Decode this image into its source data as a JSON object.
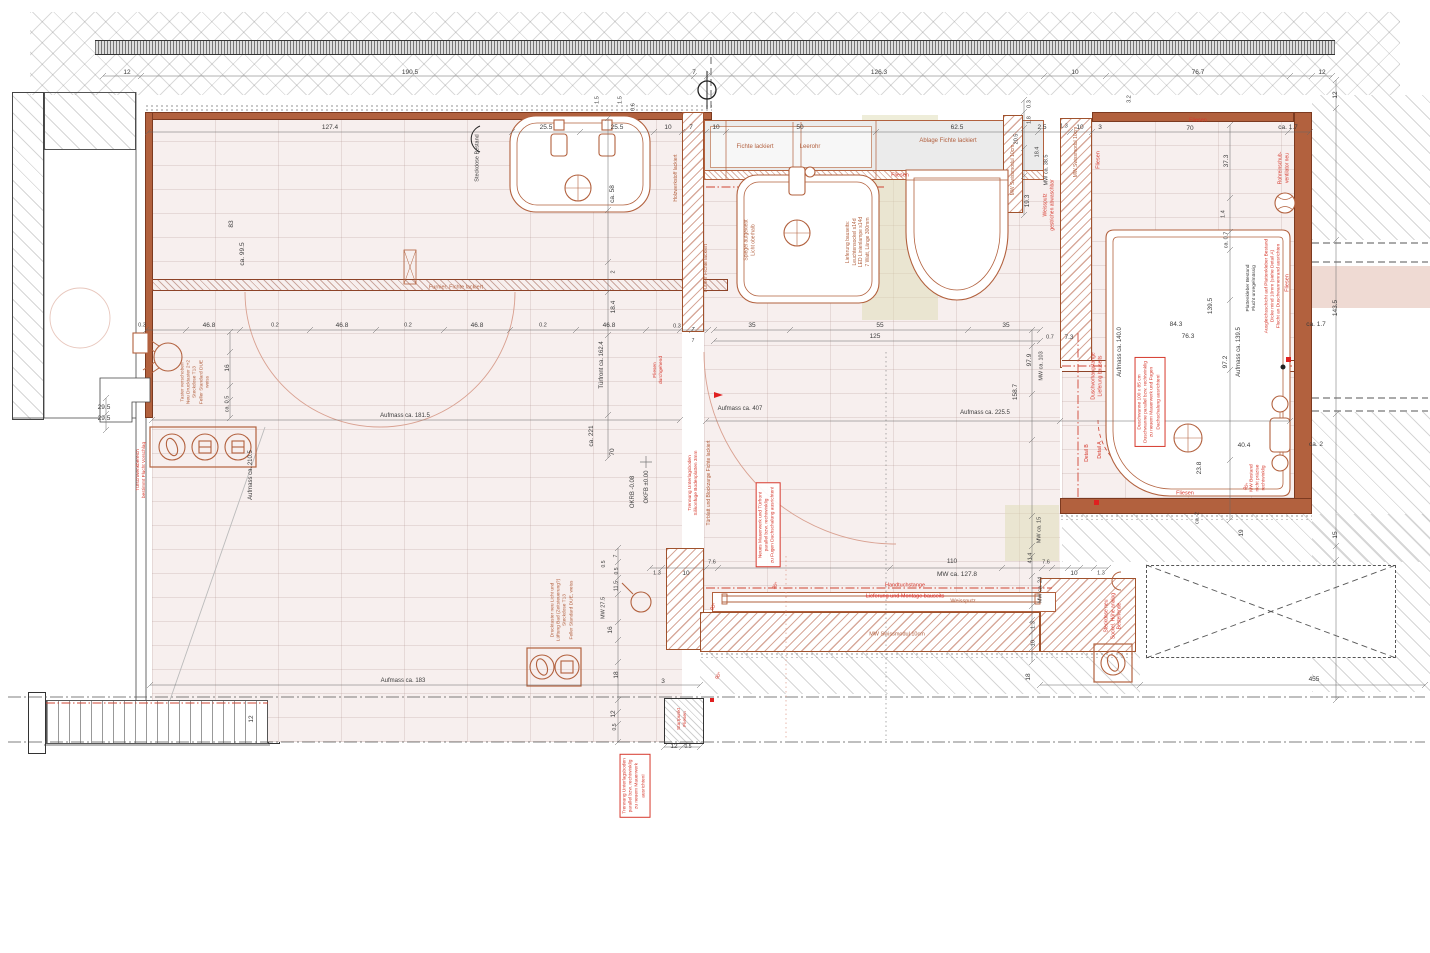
{
  "drawing": {
    "kind": "bathroom renovation floor plan",
    "language": "de"
  },
  "colors": {
    "dim_text": "#3c3c3c",
    "red_note": "#d6382c",
    "wood_note": "#b2603f",
    "wall": "#b2613e"
  },
  "annotations": [
    {
      "t": "12",
      "x": 127,
      "y": 73
    },
    {
      "t": "190.5",
      "x": 410,
      "y": 73
    },
    {
      "t": "7",
      "x": 694,
      "y": 73
    },
    {
      "t": "126.3",
      "x": 879,
      "y": 73
    },
    {
      "t": "10",
      "x": 1075,
      "y": 73
    },
    {
      "t": "76.7",
      "x": 1198,
      "y": 73
    },
    {
      "t": "12",
      "x": 1322,
      "y": 73
    },
    {
      "t": "12",
      "x": 1336,
      "y": 95,
      "r": -90
    },
    {
      "t": "127.4",
      "x": 330,
      "y": 128
    },
    {
      "t": "25.5",
      "x": 546,
      "y": 128
    },
    {
      "t": "25.5",
      "x": 617,
      "y": 128
    },
    {
      "t": "10",
      "x": 668,
      "y": 128
    },
    {
      "t": "7",
      "x": 691,
      "y": 128
    },
    {
      "t": "10",
      "x": 716,
      "y": 128
    },
    {
      "t": "1.5",
      "x": 598,
      "y": 100,
      "r": -90,
      "s": 5.5
    },
    {
      "t": "1.5",
      "x": 621,
      "y": 100,
      "r": -90,
      "s": 5.5
    },
    {
      "t": "0.6",
      "x": 634,
      "y": 107,
      "r": -90,
      "s": 5.5
    },
    {
      "t": "50",
      "x": 800,
      "y": 128
    },
    {
      "t": "62.5",
      "x": 957,
      "y": 128
    },
    {
      "t": "2.5",
      "x": 1042,
      "y": 128
    },
    {
      "t": "1.3",
      "x": 1064,
      "y": 127,
      "s": 5.5
    },
    {
      "t": "10",
      "x": 1080,
      "y": 128
    },
    {
      "t": "3",
      "x": 1100,
      "y": 128
    },
    {
      "t": "70",
      "x": 1190,
      "y": 129
    },
    {
      "t": "ca. 1.7",
      "x": 1288,
      "y": 128
    },
    {
      "t": "Fliesen",
      "x": 1198,
      "y": 121,
      "c": "r",
      "s": 5.5
    },
    {
      "t": "3.2",
      "x": 1130,
      "y": 99,
      "r": -90,
      "s": 5.5
    },
    {
      "t": "0.3",
      "x": 1030,
      "y": 104,
      "r": -90,
      "s": 5.5
    },
    {
      "t": "1.8",
      "x": 1030,
      "y": 120,
      "r": -90,
      "s": 5.5
    },
    {
      "t": "20.5",
      "x": 1017,
      "y": 139,
      "r": -90,
      "s": 5.5
    },
    {
      "t": "18.4",
      "x": 1038,
      "y": 152,
      "r": -90,
      "s": 5.5
    },
    {
      "t": "MW ca. 38.5",
      "x": 1047,
      "y": 170,
      "r": -90,
      "s": 5.5
    },
    {
      "t": "19.3",
      "x": 1028,
      "y": 201,
      "r": -90
    },
    {
      "t": "MW Swissmodul 10cm",
      "x": 1013,
      "y": 170,
      "r": -90,
      "c": "b",
      "s": 5
    },
    {
      "t": "MW Swissmodul 10cm",
      "x": 1076,
      "y": 152,
      "r": -90,
      "c": "b",
      "s": 5
    },
    {
      "t": "Fliesen",
      "x": 1099,
      "y": 160,
      "r": -90,
      "c": "r",
      "s": 5.5
    },
    {
      "t": "Fichte lackiert",
      "x": 755,
      "y": 148,
      "c": "b",
      "s": 6
    },
    {
      "t": "Leerohr",
      "x": 810,
      "y": 148,
      "c": "b",
      "s": 6
    },
    {
      "t": "Ablage Fichte lackiert",
      "x": 948,
      "y": 142,
      "c": "b",
      "s": 6
    },
    {
      "t": "Fliesen",
      "x": 900,
      "y": 176,
      "c": "r",
      "s": 5.5
    },
    {
      "t": "Weissputz\ngestrichen abwaschbar",
      "x": 1049,
      "y": 205,
      "r": -90,
      "c": "r",
      "s": 5
    },
    {
      "t": "Rohreinschub-\nventilator neu",
      "x": 1284,
      "y": 168,
      "r": -90,
      "c": "r",
      "s": 5
    },
    {
      "t": "37.3",
      "x": 1227,
      "y": 161,
      "r": -90
    },
    {
      "t": "1.4",
      "x": 1224,
      "y": 214,
      "r": -90,
      "s": 5.5
    },
    {
      "t": "ca. 0.7",
      "x": 1227,
      "y": 240,
      "r": -90,
      "s": 5.5
    },
    {
      "t": "Fliesen",
      "x": 1288,
      "y": 283,
      "r": -90,
      "c": "r",
      "s": 5.5
    },
    {
      "t": "143.5",
      "x": 1336,
      "y": 308,
      "r": -90
    },
    {
      "t": "Ausgleichsschicht auf Plattenkleber Bestand\nDicke mind 10mm (siehe Detail A)\nFlucht an Duschwannenrand ausrichten",
      "x": 1274,
      "y": 286,
      "r": -90,
      "c": "r",
      "s": 4.8
    },
    {
      "t": "Plattenkleber Bestand\nFlucht unregelmässig",
      "x": 1252,
      "y": 288,
      "r": -90,
      "s": 4.8
    },
    {
      "t": "139.5",
      "x": 1211,
      "y": 306,
      "r": -90
    },
    {
      "t": "84.3",
      "x": 1176,
      "y": 325
    },
    {
      "t": "76.3",
      "x": 1188,
      "y": 337
    },
    {
      "t": "Aufmass ca. 140.0",
      "x": 1121,
      "y": 352,
      "r": -90,
      "s": 6
    },
    {
      "t": "Aufmass ca. 139.5",
      "x": 1240,
      "y": 352,
      "r": -90,
      "s": 6
    },
    {
      "t": "97.2",
      "x": 1226,
      "y": 362,
      "r": -90
    },
    {
      "t": "0.7",
      "x": 1050,
      "y": 338,
      "s": 5.5
    },
    {
      "t": "7.3",
      "x": 1069,
      "y": 338
    },
    {
      "t": "Duschvorhangstange\nLieferung bauseits",
      "x": 1097,
      "y": 376,
      "r": -90,
      "c": "r",
      "s": 5
    },
    {
      "t": "Duschwanne 100 x 85 cm\nDuschwanne parallel bzw. rechtwinklig\nzu neuem Mauerwerk und Fugen\nDachschalung ausrichten!",
      "x": 1150,
      "y": 402,
      "r": -90,
      "c": "r",
      "s": 4.8,
      "bx": true
    },
    {
      "t": "Detail A",
      "x": 1100,
      "y": 450,
      "r": -90,
      "c": "r",
      "s": 5
    },
    {
      "t": "Detail B",
      "x": 1087,
      "y": 453,
      "r": -90,
      "c": "r",
      "s": 5
    },
    {
      "t": "23.8",
      "x": 1200,
      "y": 468,
      "r": -90
    },
    {
      "t": "40.4",
      "x": 1244,
      "y": 446
    },
    {
      "t": "ca. 2",
      "x": 1316,
      "y": 445
    },
    {
      "t": "MW Bestand\nnicht präzise\nrechtwinklig",
      "x": 1259,
      "y": 478,
      "r": -90,
      "c": "r",
      "s": 4.8
    },
    {
      "t": "90°",
      "x": 1247,
      "y": 487,
      "r": -60,
      "c": "r",
      "s": 5
    },
    {
      "t": "Fliesen",
      "x": 1185,
      "y": 494,
      "c": "r",
      "s": 5.5
    },
    {
      "t": "ca. 2",
      "x": 1198,
      "y": 518,
      "r": -90,
      "s": 5.5
    },
    {
      "t": "19",
      "x": 1242,
      "y": 533,
      "r": -90
    },
    {
      "t": "15",
      "x": 1336,
      "y": 535,
      "r": -90
    },
    {
      "t": "ca. 1.7",
      "x": 1316,
      "y": 325
    },
    {
      "t": "97.9",
      "x": 1030,
      "y": 360,
      "r": -90
    },
    {
      "t": "MW ca. 103",
      "x": 1042,
      "y": 366,
      "r": -90,
      "s": 5.5
    },
    {
      "t": "158.7",
      "x": 1016,
      "y": 392,
      "r": -90
    },
    {
      "t": "MW ca. 15",
      "x": 1040,
      "y": 530,
      "r": -90,
      "s": 5.5
    },
    {
      "t": "41.4",
      "x": 1031,
      "y": 558,
      "r": -90,
      "s": 5.5
    },
    {
      "t": "7.6",
      "x": 1046,
      "y": 563,
      "s": 5.5
    },
    {
      "t": "MW ca. 24",
      "x": 1041,
      "y": 590,
      "r": -90,
      "s": 5.5
    },
    {
      "t": "1.3",
      "x": 1034,
      "y": 625,
      "r": -90,
      "s": 5.5
    },
    {
      "t": "10",
      "x": 1034,
      "y": 643,
      "r": -90,
      "s": 5.5
    },
    {
      "t": "18",
      "x": 1029,
      "y": 677,
      "r": -90
    },
    {
      "t": "10",
      "x": 1074,
      "y": 574
    },
    {
      "t": "1.3",
      "x": 1101,
      "y": 574,
      "s": 5.5
    },
    {
      "t": "Steckdose neu\nSockel, Höhe analog\nBestehende",
      "x": 1113,
      "y": 616,
      "r": -90,
      "c": "r",
      "s": 5
    },
    {
      "t": "455",
      "x": 1314,
      "y": 680
    },
    {
      "t": "110",
      "x": 952,
      "y": 562
    },
    {
      "t": "MW ca. 127.8",
      "x": 957,
      "y": 575
    },
    {
      "t": "Handtuchstange",
      "x": 905,
      "y": 586,
      "c": "r",
      "s": 5.5
    },
    {
      "t": "Lieferung und Montage bauseits",
      "x": 905,
      "y": 597,
      "c": "r",
      "s": 5.5,
      "st": true
    },
    {
      "t": "Weissputz",
      "x": 963,
      "y": 602,
      "c": "b",
      "s": 5.5
    },
    {
      "t": "MW Swissmodul 10cm",
      "x": 897,
      "y": 635,
      "c": "b",
      "s": 5.5
    },
    {
      "t": "7.6",
      "x": 712,
      "y": 563,
      "s": 5.5
    },
    {
      "t": "1.3",
      "x": 657,
      "y": 574,
      "s": 5.5
    },
    {
      "t": "10",
      "x": 686,
      "y": 574
    },
    {
      "t": "90°",
      "x": 714,
      "y": 607,
      "r": -60,
      "c": "r",
      "s": 5
    },
    {
      "t": "90°",
      "x": 776,
      "y": 586,
      "r": -60,
      "c": "r",
      "s": 5
    },
    {
      "t": "90°",
      "x": 719,
      "y": 676,
      "r": -60,
      "c": "r",
      "s": 5
    },
    {
      "t": "3",
      "x": 663,
      "y": 682
    },
    {
      "t": "18",
      "x": 617,
      "y": 675,
      "r": -90
    },
    {
      "t": "16",
      "x": 611,
      "y": 630,
      "r": -90
    },
    {
      "t": "MW 27.5",
      "x": 604,
      "y": 608,
      "r": -90,
      "s": 5.5
    },
    {
      "t": "11.5",
      "x": 617,
      "y": 586,
      "r": -90,
      "s": 5.5
    },
    {
      "t": "0.5",
      "x": 617,
      "y": 571,
      "r": -90,
      "s": 5
    },
    {
      "t": "7",
      "x": 616,
      "y": 556,
      "r": -90,
      "s": 5
    },
    {
      "t": "0.5",
      "x": 604,
      "y": 564,
      "r": -90,
      "s": 5
    },
    {
      "t": "12",
      "x": 614,
      "y": 714,
      "r": -90
    },
    {
      "t": "0.5",
      "x": 615,
      "y": 727,
      "r": -90,
      "s": 5
    },
    {
      "t": "12",
      "x": 674,
      "y": 747
    },
    {
      "t": "0.5",
      "x": 688,
      "y": 747,
      "s": 5
    },
    {
      "t": "Startpunkt\nFliesen",
      "x": 683,
      "y": 719,
      "r": -90,
      "c": "r",
      "s": 4.8
    },
    {
      "t": "Trennung Unterlagsboden\nparallel bzw. rechtwinklig\nzu neuem Mauerwerk\nausrichten!",
      "x": 635,
      "y": 786,
      "r": -90,
      "c": "r",
      "s": 4.8,
      "bx": true
    },
    {
      "t": "Drucktaster neu Licht und\nLüftung Bad (Zeitsteuerung?)\nSteckdose T13\nFeller Standard DUE, weiss",
      "x": 563,
      "y": 610,
      "r": -90,
      "c": "b",
      "s": 4.8
    },
    {
      "t": "Aufmass ca. 183",
      "x": 403,
      "y": 682,
      "s": 6
    },
    {
      "t": "12",
      "x": 252,
      "y": 719,
      "r": -90
    },
    {
      "t": "Aufmass ca. 407",
      "x": 740,
      "y": 410,
      "s": 6
    },
    {
      "t": "Aufmass ca. 225.5",
      "x": 985,
      "y": 414,
      "s": 6
    },
    {
      "t": "Aufmass ca. 181.5",
      "x": 405,
      "y": 417,
      "s": 6
    },
    {
      "t": "Aufmass ca. 210.5",
      "x": 252,
      "y": 475,
      "r": -90,
      "s": 6
    },
    {
      "t": "OKFB ±0.00",
      "x": 648,
      "y": 487,
      "r": -90,
      "s": 6
    },
    {
      "t": "OKRB -0.08",
      "x": 634,
      "y": 492,
      "r": -90,
      "s": 6
    },
    {
      "t": "Türblatt und Blockzarge Fichte lackiert",
      "x": 709,
      "y": 483,
      "r": -90,
      "c": "b",
      "s": 5
    },
    {
      "t": "Trennung Unterlagsboden\nSilikonfuge Bodenplatten 3mm",
      "x": 694,
      "y": 483,
      "r": -90,
      "c": "r",
      "s": 4.8
    },
    {
      "t": "Neues Mauerwerk und Türfront\nparallel bzw. rechtwinklig\nzu Fugen Dachschalung ausrichten!",
      "x": 768,
      "y": 525,
      "r": -90,
      "c": "r",
      "s": 4.8,
      "bx": true
    },
    {
      "t": "Fliesen\ndurchgehend",
      "x": 659,
      "y": 370,
      "r": -90,
      "c": "r",
      "s": 4.8
    },
    {
      "t": "Türfront ca. 162.4",
      "x": 603,
      "y": 365,
      "r": -90,
      "s": 6
    },
    {
      "t": "ca. 221",
      "x": 592,
      "y": 436,
      "r": -90
    },
    {
      "t": "70",
      "x": 613,
      "y": 452,
      "r": -90
    },
    {
      "t": "18.4",
      "x": 614,
      "y": 307,
      "r": -90
    },
    {
      "t": "2",
      "x": 614,
      "y": 272,
      "r": -90,
      "s": 5.5
    },
    {
      "t": "ca. 58",
      "x": 613,
      "y": 194,
      "r": -90
    },
    {
      "t": "Holzwerkstoff lackiert",
      "x": 676,
      "y": 178,
      "r": -90,
      "c": "b",
      "s": 5
    },
    {
      "t": "Furnier Fichte lackiert",
      "x": 706,
      "y": 268,
      "r": -90,
      "c": "b",
      "s": 5
    },
    {
      "t": "Furnier, Fichte lackiert",
      "x": 456,
      "y": 288,
      "c": "b",
      "s": 5.5
    },
    {
      "t": "Steckdose Bestand",
      "x": 478,
      "y": 158,
      "r": -90,
      "s": 5.5
    },
    {
      "t": "Spiegel aufgeklebt\nLicht oberhalb",
      "x": 750,
      "y": 240,
      "r": -90,
      "c": "b",
      "s": 5
    },
    {
      "t": "Lieferung bauseits:\nLeuchtensockel s14d\nLED Linienlampe s14d\n7 Watt, Länge 300mm",
      "x": 858,
      "y": 242,
      "r": -90,
      "c": "b",
      "s": 5
    },
    {
      "t": "35",
      "x": 752,
      "y": 326
    },
    {
      "t": "55",
      "x": 880,
      "y": 326
    },
    {
      "t": "35",
      "x": 1006,
      "y": 326
    },
    {
      "t": "125",
      "x": 875,
      "y": 337
    },
    {
      "t": "0.3",
      "x": 142,
      "y": 326,
      "s": 5.5
    },
    {
      "t": "46.8",
      "x": 209,
      "y": 326
    },
    {
      "t": "0.2",
      "x": 275,
      "y": 326,
      "s": 5.5
    },
    {
      "t": "46.8",
      "x": 342,
      "y": 326
    },
    {
      "t": "0.2",
      "x": 408,
      "y": 326,
      "s": 5.5
    },
    {
      "t": "46.8",
      "x": 477,
      "y": 326
    },
    {
      "t": "0.2",
      "x": 543,
      "y": 326,
      "s": 5.5
    },
    {
      "t": "46.8",
      "x": 609,
      "y": 326
    },
    {
      "t": "0.3",
      "x": 677,
      "y": 327,
      "s": 5.5
    },
    {
      "t": "7",
      "x": 693,
      "y": 330,
      "s": 5
    },
    {
      "t": "7",
      "x": 693,
      "y": 341,
      "s": 5
    },
    {
      "t": "83",
      "x": 232,
      "y": 224,
      "r": -90
    },
    {
      "t": "ca. 99.5",
      "x": 243,
      "y": 254,
      "r": -90
    },
    {
      "t": "16",
      "x": 228,
      "y": 368,
      "r": -90
    },
    {
      "t": "ca. 0.5",
      "x": 228,
      "y": 404,
      "r": -90,
      "s": 5.5
    },
    {
      "t": "29.5",
      "x": 104,
      "y": 408
    },
    {
      "t": "29.5",
      "x": 104,
      "y": 419
    },
    {
      "t": "Taster verschoben\nNeu Drucktaster 2+2\nSteckdose T13\nFeller Standard DUE\nweiss",
      "x": 196,
      "y": 382,
      "r": -90,
      "c": "b",
      "s": 4.8
    },
    {
      "t": "Türschwenkbereich\nbestimmt Flucht Vorschlag",
      "x": 142,
      "y": 470,
      "r": -90,
      "c": "r",
      "s": 4.8
    }
  ]
}
